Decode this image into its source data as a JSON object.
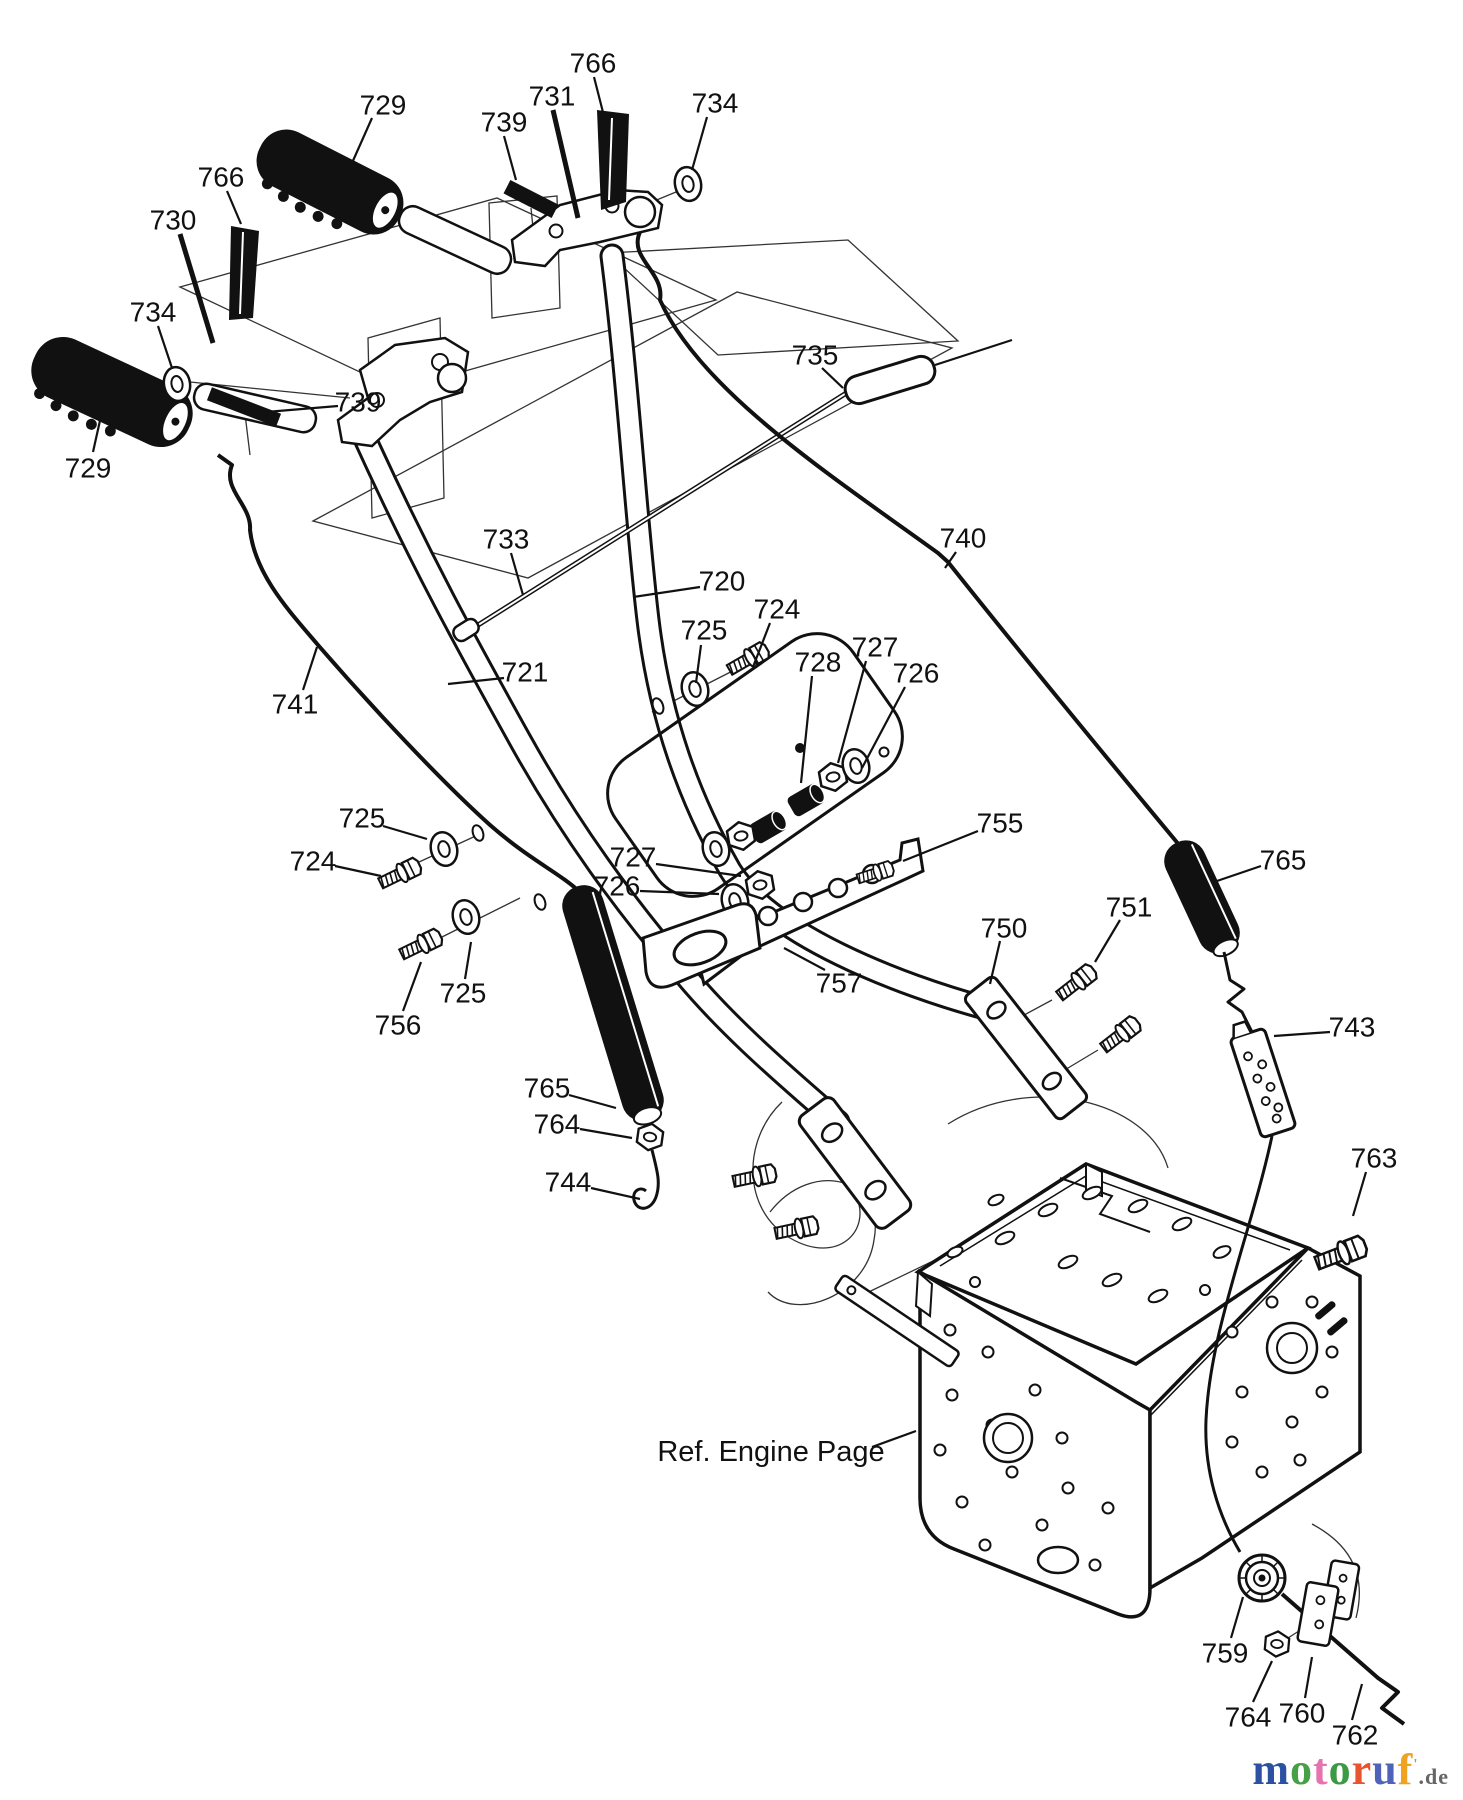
{
  "palette": {
    "line": "#111111",
    "paper": "#ffffff"
  },
  "diagram": {
    "ref_note": "Ref. Engine Page",
    "labels": [
      {
        "t": "729",
        "x": 383,
        "y": 105,
        "l": [
          372,
          118,
          352,
          163
        ]
      },
      {
        "t": "766",
        "x": 593,
        "y": 63,
        "l": [
          594,
          77,
          607,
          128
        ]
      },
      {
        "t": "731",
        "x": 552,
        "y": 96,
        "l": [
          553,
          110,
          578,
          218
        ],
        "w": 5
      },
      {
        "t": "739",
        "x": 504,
        "y": 122,
        "l": [
          504,
          136,
          516,
          180
        ]
      },
      {
        "t": "734",
        "x": 715,
        "y": 103,
        "l": [
          707,
          117,
          692,
          170
        ]
      },
      {
        "t": "729",
        "x": 88,
        "y": 468,
        "l": [
          93,
          452,
          103,
          407
        ]
      },
      {
        "t": "766",
        "x": 221,
        "y": 177,
        "l": [
          227,
          191,
          241,
          224
        ]
      },
      {
        "t": "730",
        "x": 173,
        "y": 220,
        "l": [
          180,
          234,
          213,
          343
        ],
        "w": 5
      },
      {
        "t": "734",
        "x": 153,
        "y": 312,
        "l": [
          158,
          326,
          172,
          368
        ]
      },
      {
        "t": "739",
        "x": 358,
        "y": 402,
        "l": [
          338,
          406,
          266,
          412
        ]
      },
      {
        "t": "735",
        "x": 815,
        "y": 355,
        "l": [
          822,
          368,
          843,
          388
        ]
      },
      {
        "t": "740",
        "x": 963,
        "y": 538,
        "l": [
          956,
          552,
          945,
          568
        ]
      },
      {
        "t": "733",
        "x": 506,
        "y": 539,
        "l": [
          511,
          553,
          523,
          595
        ]
      },
      {
        "t": "720",
        "x": 722,
        "y": 581,
        "l": [
          700,
          587,
          633,
          597
        ]
      },
      {
        "t": "721",
        "x": 525,
        "y": 672,
        "l": [
          504,
          678,
          448,
          684
        ]
      },
      {
        "t": "741",
        "x": 295,
        "y": 704,
        "l": [
          303,
          690,
          317,
          647
        ]
      },
      {
        "t": "725",
        "x": 704,
        "y": 630,
        "l": [
          701,
          645,
          696,
          683
        ]
      },
      {
        "t": "724",
        "x": 777,
        "y": 609,
        "l": [
          770,
          623,
          753,
          667
        ]
      },
      {
        "t": "728",
        "x": 818,
        "y": 662,
        "l": [
          812,
          676,
          801,
          783
        ]
      },
      {
        "t": "727",
        "x": 875,
        "y": 647,
        "l": [
          866,
          661,
          838,
          763
        ]
      },
      {
        "t": "726",
        "x": 916,
        "y": 673,
        "l": [
          905,
          687,
          862,
          768
        ]
      },
      {
        "t": "725",
        "x": 362,
        "y": 818,
        "l": [
          383,
          826,
          427,
          839
        ]
      },
      {
        "t": "724",
        "x": 313,
        "y": 861,
        "l": [
          335,
          866,
          381,
          876
        ]
      },
      {
        "t": "727",
        "x": 633,
        "y": 857,
        "l": [
          656,
          864,
          741,
          876
        ]
      },
      {
        "t": "726",
        "x": 617,
        "y": 886,
        "l": [
          640,
          891,
          719,
          894
        ]
      },
      {
        "t": "755",
        "x": 1000,
        "y": 823,
        "l": [
          978,
          831,
          903,
          861
        ]
      },
      {
        "t": "765",
        "x": 1283,
        "y": 860,
        "l": [
          1261,
          866,
          1214,
          882
        ]
      },
      {
        "t": "751",
        "x": 1129,
        "y": 907,
        "l": [
          1120,
          920,
          1095,
          962
        ]
      },
      {
        "t": "750",
        "x": 1004,
        "y": 928,
        "l": [
          1000,
          941,
          990,
          984
        ]
      },
      {
        "t": "743",
        "x": 1352,
        "y": 1027,
        "l": [
          1330,
          1032,
          1274,
          1036
        ]
      },
      {
        "t": "725",
        "x": 463,
        "y": 993,
        "l": [
          465,
          979,
          471,
          942
        ]
      },
      {
        "t": "756",
        "x": 398,
        "y": 1025,
        "l": [
          403,
          1011,
          421,
          962
        ]
      },
      {
        "t": "757",
        "x": 839,
        "y": 983,
        "l": [
          825,
          970,
          784,
          948
        ]
      },
      {
        "t": "765",
        "x": 547,
        "y": 1088,
        "l": [
          569,
          1095,
          616,
          1108
        ]
      },
      {
        "t": "764",
        "x": 557,
        "y": 1124,
        "l": [
          580,
          1129,
          632,
          1138
        ]
      },
      {
        "t": "744",
        "x": 568,
        "y": 1182,
        "l": [
          591,
          1188,
          640,
          1199
        ]
      },
      {
        "t": "763",
        "x": 1374,
        "y": 1158,
        "l": [
          1366,
          1172,
          1353,
          1216
        ]
      },
      {
        "t": "759",
        "x": 1225,
        "y": 1653,
        "l": [
          1231,
          1638,
          1243,
          1597
        ]
      },
      {
        "t": "764",
        "x": 1248,
        "y": 1717,
        "l": [
          1253,
          1702,
          1272,
          1661
        ]
      },
      {
        "t": "760",
        "x": 1302,
        "y": 1713,
        "l": [
          1305,
          1698,
          1312,
          1657
        ]
      },
      {
        "t": "762",
        "x": 1355,
        "y": 1735,
        "l": [
          1352,
          1720,
          1362,
          1684
        ]
      },
      {
        "t": "Ref. Engine Page",
        "x": 771,
        "y": 1452,
        "l": [
          872,
          1447,
          916,
          1431
        ],
        "fs": 29
      }
    ]
  },
  "logo": {
    "letters": [
      {
        "ch": "m",
        "color": "#2c51a2"
      },
      {
        "ch": "o",
        "color": "#45a047"
      },
      {
        "ch": "t",
        "color": "#e473ae"
      },
      {
        "ch": "o",
        "color": "#3d9a44"
      },
      {
        "ch": "r",
        "color": "#e8542e"
      },
      {
        "ch": "u",
        "color": "#4f63b8"
      },
      {
        "ch": "f",
        "color": "#f0a223"
      }
    ],
    "mark": "'",
    "suffix": ".de"
  }
}
